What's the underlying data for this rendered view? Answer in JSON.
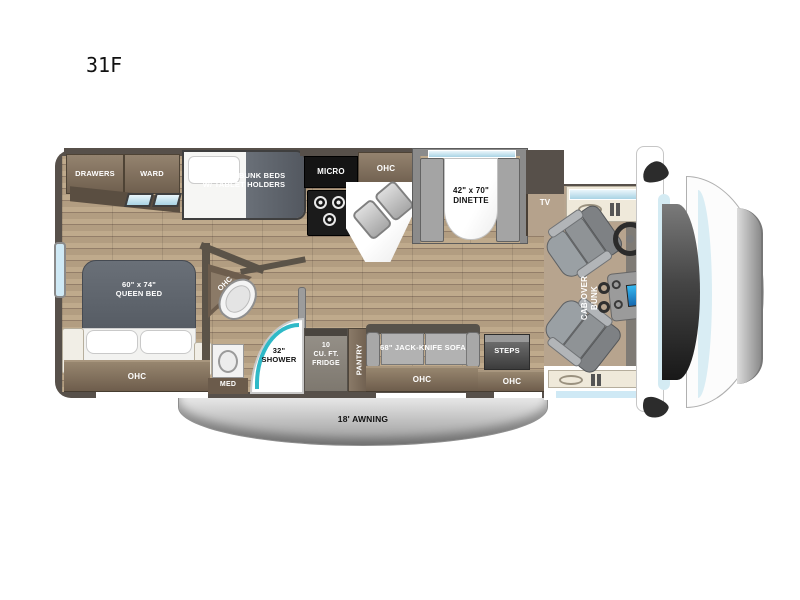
{
  "title": "31F",
  "colors": {
    "accent_teal": "#2fb9c7",
    "window_blue": "#cfe9f5",
    "wall_brown": "#57504a",
    "floor_wood": "#b29d81",
    "cabinet_brown": "#7d6c5a",
    "mattress_gray": "#5c6169",
    "awning_gray": "#c9c9c9"
  },
  "floorplan": {
    "bedroom": {
      "drawers": "DRAWERS",
      "ward": "WARD",
      "bunk_beds": "28\" x 72\" BUNK BEDS\nW/ TABLET HOLDERS",
      "queen_bed": "60\" x 74\"\nQUEEN BED",
      "ohc": "OHC"
    },
    "bathroom": {
      "ohc": "OHC",
      "med": "MED",
      "shower": "32\"\nSHOWER"
    },
    "kitchen": {
      "micro": "MICRO",
      "ohc": "OHC",
      "fridge": "10\nCU. FT.\nFRIDGE",
      "pantry": "PANTRY"
    },
    "living": {
      "dinette": "42\" x 70\"\nDINETTE",
      "tv": "TV",
      "sofa": "68\" JACK-KNIFE SOFA",
      "sofa_ohc": "OHC",
      "steps": "STEPS",
      "steps_ohc": "OHC"
    },
    "cab": {
      "cab_over_bunk": "CAB-OVER\nBUNK"
    },
    "exterior": {
      "awning": "18' AWNING"
    }
  }
}
